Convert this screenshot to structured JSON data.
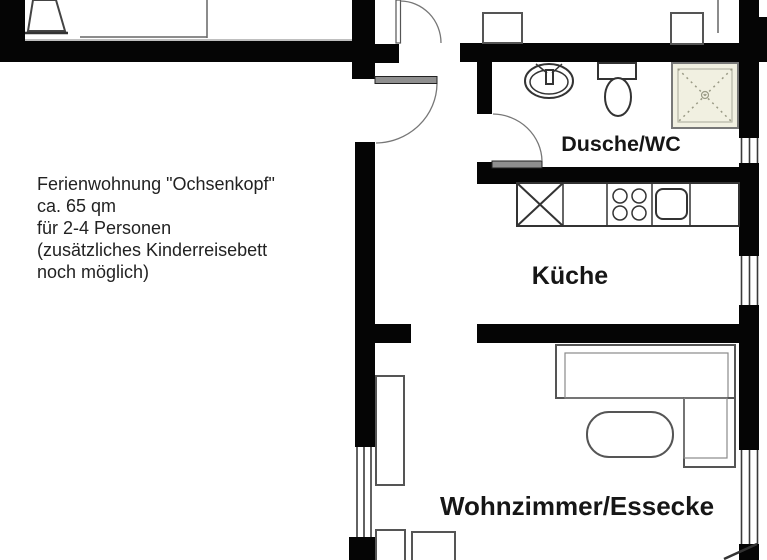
{
  "plan": {
    "background": "#ffffff",
    "wall_color": "#050505",
    "shower_tile_color": "#f1f0e1",
    "annotation": {
      "lines": [
        "Ferienwohnung \"Ochsenkopf\"",
        "ca. 65 qm",
        "für 2-4 Personen",
        "(zusätzliches Kinderreisebett",
        "noch möglich)"
      ]
    },
    "rooms": [
      {
        "id": "bathroom",
        "label": "Dusche/WC"
      },
      {
        "id": "kitchen",
        "label": "Küche"
      },
      {
        "id": "living_dining",
        "label": "Wohnzimmer/Essecke"
      }
    ],
    "fixtures": [
      "washbasin-icon",
      "toilet-icon",
      "shower-tray-icon",
      "stove-burners-icon",
      "kitchen-sink-icon",
      "kitchen-counter",
      "corner-sofa",
      "dining-table",
      "shelf",
      "chair",
      "tiled-stove",
      "bed-edge",
      "nightstand"
    ]
  }
}
